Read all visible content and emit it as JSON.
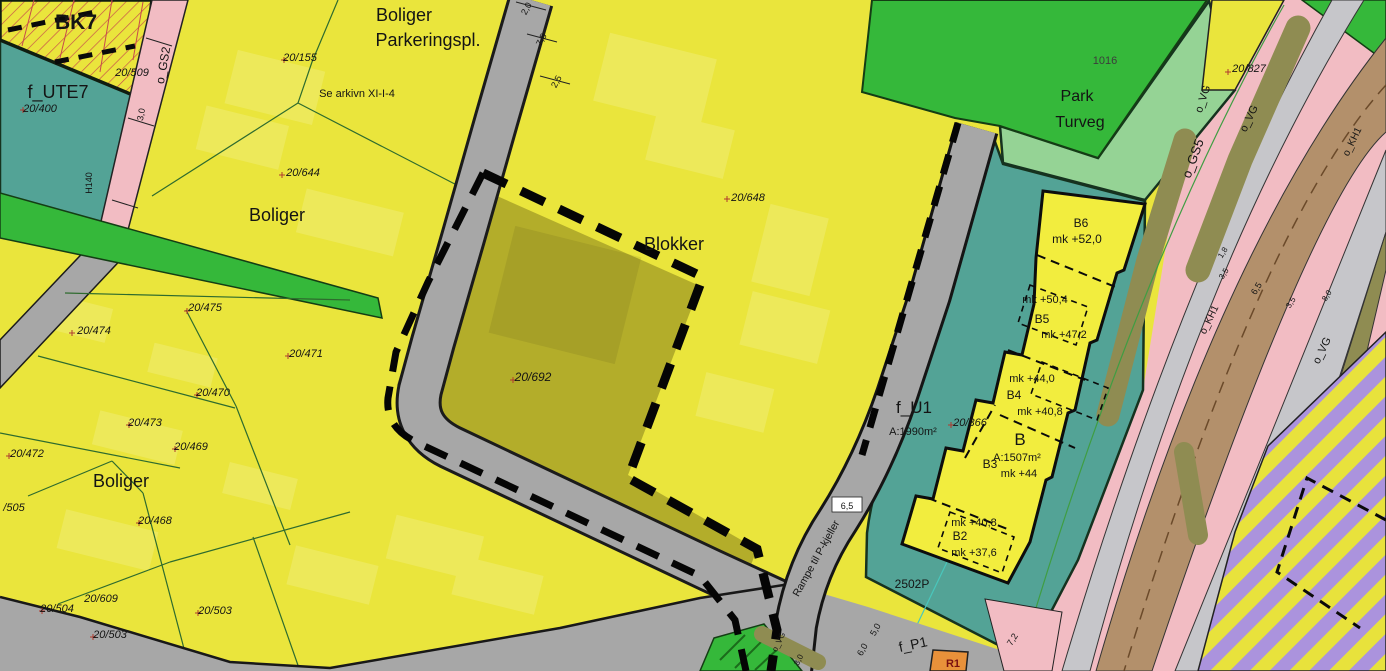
{
  "map": {
    "type": "zoning-plan-map",
    "colors": {
      "residential_yellow": "#eae53c",
      "field_yellow": "#f2ed3e",
      "olive_parcel": "#b3ad2a",
      "bright_green": "#35b83a",
      "light_green_park": "#95d395",
      "teal_area": "#53a396",
      "pink_path": "#f2bcc3",
      "road_gray": "#a7a7a7",
      "corridor_gray": "#c6c6ca",
      "brown_road": "#b3906b",
      "olive_strip": "#8f8c52",
      "purple_hatch": "#ab93dd",
      "orange_area": "#e8913a",
      "boundary_dash": "#0a0a0a",
      "parcel_line_green": "#2e6b2e",
      "red_hatch": "#c84b4b",
      "cross_red": "#b03a2e"
    },
    "labels": {
      "area_labels": [
        {
          "n": "label-bk7",
          "t": "BK7",
          "x": 76,
          "y": 29,
          "s": 21,
          "w": 600
        },
        {
          "n": "label-f-ute7",
          "t": "f_UTE7",
          "x": 58,
          "y": 98,
          "s": 18
        },
        {
          "n": "label-boliger-top",
          "t": "Boliger",
          "x": 404,
          "y": 21,
          "s": 18
        },
        {
          "n": "label-parkeringspl",
          "t": "Parkeringspl.",
          "x": 428,
          "y": 46,
          "s": 18
        },
        {
          "n": "label-boliger-mid",
          "t": "Boliger",
          "x": 277,
          "y": 221,
          "s": 18
        },
        {
          "n": "label-blokker",
          "t": "Blokker",
          "x": 674,
          "y": 250,
          "s": 18
        },
        {
          "n": "label-boliger-bottom",
          "t": "Boliger",
          "x": 121,
          "y": 487,
          "s": 18
        },
        {
          "n": "label-park",
          "t": "Park",
          "x": 1077,
          "y": 101,
          "s": 16
        },
        {
          "n": "label-turveg",
          "t": "Turveg",
          "x": 1080,
          "y": 127,
          "s": 16
        },
        {
          "n": "label-b6",
          "t": "B6",
          "x": 1081,
          "y": 227,
          "s": 12
        },
        {
          "n": "label-b5",
          "t": "B5",
          "x": 1042,
          "y": 323,
          "s": 12
        },
        {
          "n": "label-b4",
          "t": "B4",
          "x": 1014,
          "y": 399,
          "s": 12
        },
        {
          "n": "label-b",
          "t": "B",
          "x": 1020,
          "y": 445,
          "s": 17
        },
        {
          "n": "label-b3",
          "t": "B3",
          "x": 990,
          "y": 468,
          "s": 12
        },
        {
          "n": "label-b2",
          "t": "B2",
          "x": 960,
          "y": 540,
          "s": 12
        },
        {
          "n": "label-f-u1",
          "t": "f_U1",
          "x": 914,
          "y": 413,
          "s": 17
        },
        {
          "n": "label-f-p1",
          "t": "f_P1",
          "x": 914,
          "y": 649,
          "s": 14,
          "r": -12
        },
        {
          "n": "label-r1",
          "t": "R1",
          "x": 953,
          "y": 667,
          "s": 11,
          "w": 700,
          "c": "#7a1010"
        },
        {
          "n": "label-2502p",
          "t": "2502P",
          "x": 912,
          "y": 588,
          "s": 12
        },
        {
          "n": "label-1016",
          "t": "1016",
          "x": 1105,
          "y": 64,
          "s": 11,
          "c": "#3c3c3c"
        },
        {
          "n": "label-o-gs2",
          "t": "o_GS2",
          "x": 167,
          "y": 66,
          "s": 12,
          "r": -80
        },
        {
          "n": "label-o-gs5",
          "t": "o_GS5",
          "x": 1197,
          "y": 160,
          "s": 13,
          "r": -70
        },
        {
          "n": "label-o-vg-1",
          "t": "o_VG",
          "x": 1206,
          "y": 100,
          "s": 11,
          "r": -72
        },
        {
          "n": "label-o-vg-2",
          "t": "o_VG",
          "x": 1252,
          "y": 120,
          "s": 11,
          "r": -64
        },
        {
          "n": "label-o-vg-3",
          "t": "o_VG",
          "x": 1325,
          "y": 352,
          "s": 11,
          "r": -64
        },
        {
          "n": "label-o-vg-4",
          "t": "o_VG",
          "x": 781,
          "y": 643,
          "s": 8,
          "r": -64
        },
        {
          "n": "label-o-kh1-a",
          "t": "o_KH1",
          "x": 1355,
          "y": 143,
          "s": 10,
          "r": -64
        },
        {
          "n": "label-o-kh1-b",
          "t": "o_KH1",
          "x": 1212,
          "y": 321,
          "s": 10,
          "r": -64
        },
        {
          "n": "label-h140",
          "t": "H140",
          "x": 92,
          "y": 183,
          "s": 9,
          "r": -90
        }
      ],
      "parcel_labels": [
        {
          "n": "parcel-20-400",
          "t": "20/400",
          "x": 40,
          "y": 112,
          "s": 11,
          "i": 1
        },
        {
          "n": "parcel-20-509",
          "t": "20/509",
          "x": 132,
          "y": 76,
          "s": 11,
          "i": 1
        },
        {
          "n": "parcel-20-155",
          "t": "20/155",
          "x": 300,
          "y": 61,
          "s": 11,
          "i": 1
        },
        {
          "n": "parcel-20-644",
          "t": "20/644",
          "x": 303,
          "y": 176,
          "s": 11,
          "i": 1
        },
        {
          "n": "parcel-20-648",
          "t": "20/648",
          "x": 748,
          "y": 201,
          "s": 11,
          "i": 1
        },
        {
          "n": "parcel-20-692",
          "t": "20/692",
          "x": 533,
          "y": 381,
          "s": 12,
          "i": 1
        },
        {
          "n": "parcel-20-475",
          "t": "20/475",
          "x": 205,
          "y": 311,
          "s": 11,
          "i": 1
        },
        {
          "n": "parcel-20-474",
          "t": "20/474",
          "x": 94,
          "y": 334,
          "s": 11,
          "i": 1
        },
        {
          "n": "parcel-20-471",
          "t": "20/471",
          "x": 306,
          "y": 357,
          "s": 11,
          "i": 1
        },
        {
          "n": "parcel-20-470",
          "t": "20/470",
          "x": 213,
          "y": 396,
          "s": 11,
          "i": 1
        },
        {
          "n": "parcel-20-473",
          "t": "20/473",
          "x": 145,
          "y": 426,
          "s": 11,
          "i": 1
        },
        {
          "n": "parcel-20-469",
          "t": "20/469",
          "x": 191,
          "y": 450,
          "s": 11,
          "i": 1
        },
        {
          "n": "parcel-20-472",
          "t": "20/472",
          "x": 27,
          "y": 457,
          "s": 11,
          "i": 1
        },
        {
          "n": "parcel-505",
          "t": "/505",
          "x": 14,
          "y": 511,
          "s": 11,
          "i": 1
        },
        {
          "n": "parcel-20-468",
          "t": "20/468",
          "x": 155,
          "y": 524,
          "s": 11,
          "i": 1
        },
        {
          "n": "parcel-20-609",
          "t": "20/609",
          "x": 101,
          "y": 602,
          "s": 11,
          "i": 1
        },
        {
          "n": "parcel-20-504",
          "t": "20/504",
          "x": 57,
          "y": 612,
          "s": 11,
          "i": 1
        },
        {
          "n": "parcel-20-503-a",
          "t": "20/503",
          "x": 110,
          "y": 638,
          "s": 11,
          "i": 1
        },
        {
          "n": "parcel-20-503-b",
          "t": "20/503",
          "x": 215,
          "y": 614,
          "s": 11,
          "i": 1
        },
        {
          "n": "parcel-20-827",
          "t": "20/827",
          "x": 1249,
          "y": 72,
          "s": 11,
          "i": 1
        },
        {
          "n": "parcel-20-366",
          "t": "20/366",
          "x": 970,
          "y": 426,
          "s": 11,
          "i": 1
        }
      ],
      "elevation_labels": [
        {
          "n": "mk-b6",
          "t": "mk +52,0",
          "x": 1077,
          "y": 243,
          "s": 12
        },
        {
          "n": "mk-b5-upper",
          "t": "mk +50,4",
          "x": 1045,
          "y": 303,
          "s": 11
        },
        {
          "n": "mk-b5-lower",
          "t": "mk +47,2",
          "x": 1064,
          "y": 338,
          "s": 11
        },
        {
          "n": "mk-b4-upper",
          "t": "mk +44,0",
          "x": 1032,
          "y": 382,
          "s": 11
        },
        {
          "n": "mk-b4-lower",
          "t": "mk +40,8",
          "x": 1040,
          "y": 415,
          "s": 11
        },
        {
          "n": "area-b",
          "t": "A:1507m²",
          "x": 1017,
          "y": 461,
          "s": 11
        },
        {
          "n": "mk-b",
          "t": "mk +44",
          "x": 1019,
          "y": 477,
          "s": 11
        },
        {
          "n": "area-f-u1",
          "t": "A:1990m²",
          "x": 913,
          "y": 435,
          "s": 11
        },
        {
          "n": "mk-b2-upper",
          "t": "mk +40,8",
          "x": 974,
          "y": 526,
          "s": 11
        },
        {
          "n": "mk-b2-lower",
          "t": "mk +37,6",
          "x": 974,
          "y": 556,
          "s": 11
        }
      ],
      "dimension_labels": [
        {
          "n": "dim-2-0",
          "t": "2,0",
          "x": 529,
          "y": 10,
          "s": 9,
          "r": -62
        },
        {
          "n": "dim-7-5",
          "t": "7,5",
          "x": 544,
          "y": 41,
          "s": 9,
          "r": -62
        },
        {
          "n": "dim-2-5",
          "t": "2,5",
          "x": 559,
          "y": 83,
          "s": 9,
          "r": -62
        },
        {
          "n": "dim-3-0-gs2",
          "t": "3,0",
          "x": 144,
          "y": 115,
          "s": 9,
          "r": -80
        },
        {
          "n": "dim-6-5-ramp",
          "t": "6,5",
          "x": 847,
          "y": 509,
          "s": 9
        },
        {
          "n": "dim-5-0",
          "t": "5,0",
          "x": 878,
          "y": 631,
          "s": 9,
          "r": -62
        },
        {
          "n": "dim-6-0",
          "t": "6,0",
          "x": 865,
          "y": 651,
          "s": 9,
          "r": -62
        },
        {
          "n": "dim-7-2",
          "t": "7,2",
          "x": 1015,
          "y": 641,
          "s": 9,
          "r": -58
        },
        {
          "n": "dim-1-8",
          "t": "1,8",
          "x": 1225,
          "y": 254,
          "s": 8,
          "r": -58
        },
        {
          "n": "dim-3-5-a",
          "t": "3,5",
          "x": 1226,
          "y": 275,
          "s": 8,
          "r": -58
        },
        {
          "n": "dim-6-5-kh",
          "t": "6,5",
          "x": 1259,
          "y": 290,
          "s": 9,
          "r": -58
        },
        {
          "n": "dim-3-5-b",
          "t": "3,5",
          "x": 1293,
          "y": 304,
          "s": 8,
          "r": -58
        },
        {
          "n": "dim-8-0",
          "t": "8,0",
          "x": 1329,
          "y": 297,
          "s": 8,
          "r": -58
        },
        {
          "n": "dim-3-0-vg",
          "t": "3,0",
          "x": 801,
          "y": 661,
          "s": 8,
          "r": -64
        }
      ],
      "note_labels": [
        {
          "n": "note-arkiv",
          "t": "Se arkivn XI-I-4",
          "x": 357,
          "y": 97,
          "s": 11
        },
        {
          "n": "note-rampe",
          "t": "Rampe til P-kjeller",
          "x": 819,
          "y": 560,
          "s": 10.5,
          "r": -61
        }
      ]
    },
    "crosses": [
      [
        187,
        311
      ],
      [
        72,
        333
      ],
      [
        288,
        356
      ],
      [
        197,
        395
      ],
      [
        129,
        425
      ],
      [
        175,
        449
      ],
      [
        9,
        456
      ],
      [
        139,
        523
      ],
      [
        42,
        611
      ],
      [
        93,
        637
      ],
      [
        198,
        613
      ],
      [
        282,
        175
      ],
      [
        727,
        199
      ],
      [
        513,
        380
      ],
      [
        284,
        60
      ],
      [
        1228,
        72
      ],
      [
        951,
        425
      ],
      [
        23,
        110
      ]
    ]
  }
}
